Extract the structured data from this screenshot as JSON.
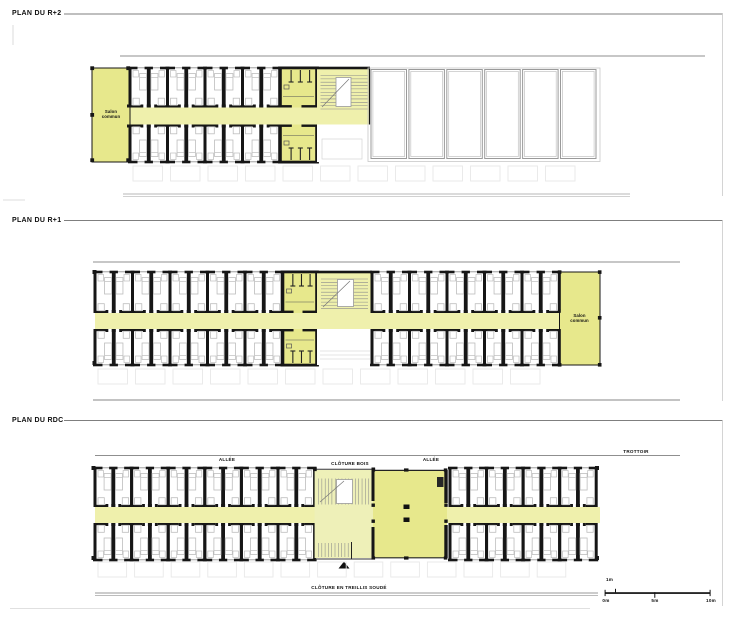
{
  "plans": {
    "r2": {
      "title": "PLAN DU R+2",
      "salon_label": "Salon\ncommun"
    },
    "r1": {
      "title": "PLAN DU R+1",
      "salon_label": "Salon\ncommun"
    },
    "rdc": {
      "title": "PLAN DU RDC",
      "labels": {
        "allee_left": "ALLÉE",
        "cloture_bois": "CLÔTURE BOIS",
        "allee_right": "ALLÉE",
        "trottoir": "TROTTOIR",
        "cloture_treillis": "CLÔTURE EN TREILLIS SOUDÉ"
      }
    }
  },
  "scale_bar": {
    "above": "1m",
    "start": "0m",
    "middle": "5m",
    "end": "10m"
  },
  "colors": {
    "room_yellow": "#e7e88c",
    "corridor_yellow": "#eff0ac",
    "stair_tint": "#eef0b8",
    "wall_black": "#161616",
    "furniture_gray": "#bdbdbd",
    "line_gray": "#8f8f8f",
    "cell_gray": "#9a9a9a",
    "faint_gray": "#c9c9c9"
  }
}
